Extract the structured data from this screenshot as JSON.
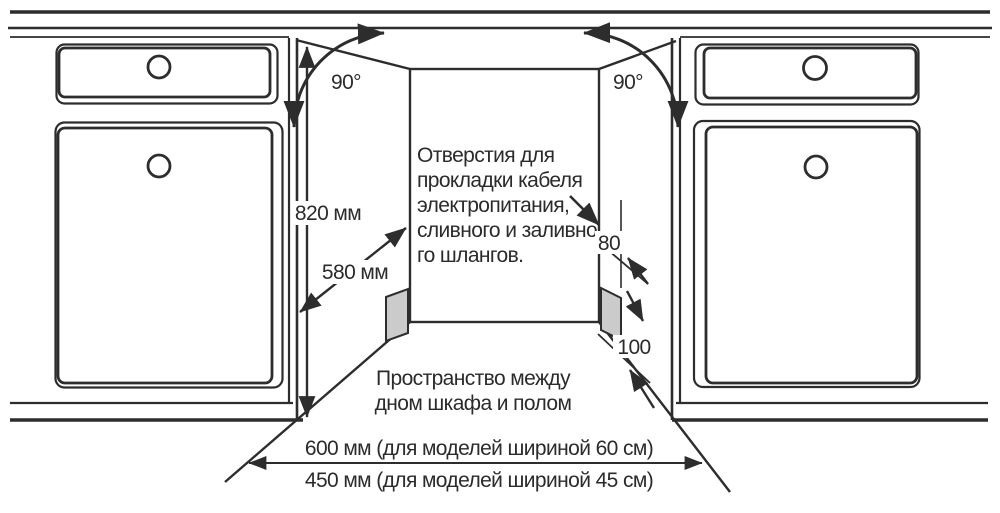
{
  "diagram": {
    "labels": {
      "height": "820 мм",
      "depth": "580 мм",
      "angle_left": "90°",
      "angle_right": "90°",
      "hole_dim": "80",
      "hole_floor_dim": "100",
      "width_60": "600 мм (для моделей шириной 60 см)",
      "width_45": "450 мм (для моделей шириной 45 см)"
    },
    "notes": {
      "holes": {
        "lines": [
          "Отверстия для",
          "прокладки кабеля",
          "электропитания,",
          "сливного и заливно",
          "го шлангов."
        ]
      },
      "floor_gap": {
        "lines": [
          "Пространство между",
          "дном шкафа и полом"
        ]
      }
    },
    "colors": {
      "line": "#2d2d2d",
      "hole_fill": "#cbcbcb",
      "background": "#ffffff"
    }
  }
}
